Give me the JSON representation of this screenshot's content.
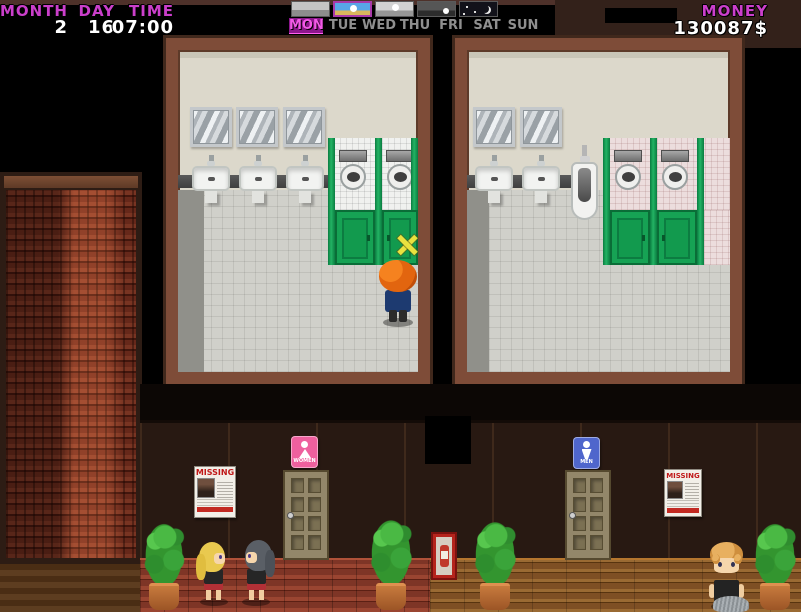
{
  "hud": {
    "calendar": {
      "month_label": "MONTH",
      "day_label": "DAY",
      "time_label": "TIME",
      "month_value": "2",
      "day_value": "16",
      "time_value": "07:00"
    },
    "weather_strip": {
      "icons": [
        {
          "name": "dawn"
        },
        {
          "name": "day"
        },
        {
          "name": "noon"
        },
        {
          "name": "dusk"
        },
        {
          "name": "night"
        }
      ],
      "selected": "day"
    },
    "weekdays": {
      "days": [
        "MON",
        "TUE",
        "WED",
        "THU",
        "FRI",
        "SAT",
        "SUN"
      ],
      "active": "MON"
    },
    "money": {
      "label": "MONEY",
      "value": "130087$"
    }
  },
  "scene": {
    "posters": {
      "left_title": "MISSING",
      "right_title": "MISSING"
    },
    "restroom_signs": {
      "women_label": "WOMEN",
      "men_label": "MEN"
    }
  },
  "colors": {
    "hud_magenta": "#cb3fcb",
    "stall_green": "#16a254",
    "sign_pink": "#ee609e",
    "sign_blue": "#4f66cc",
    "wall_brown": "#281912"
  }
}
